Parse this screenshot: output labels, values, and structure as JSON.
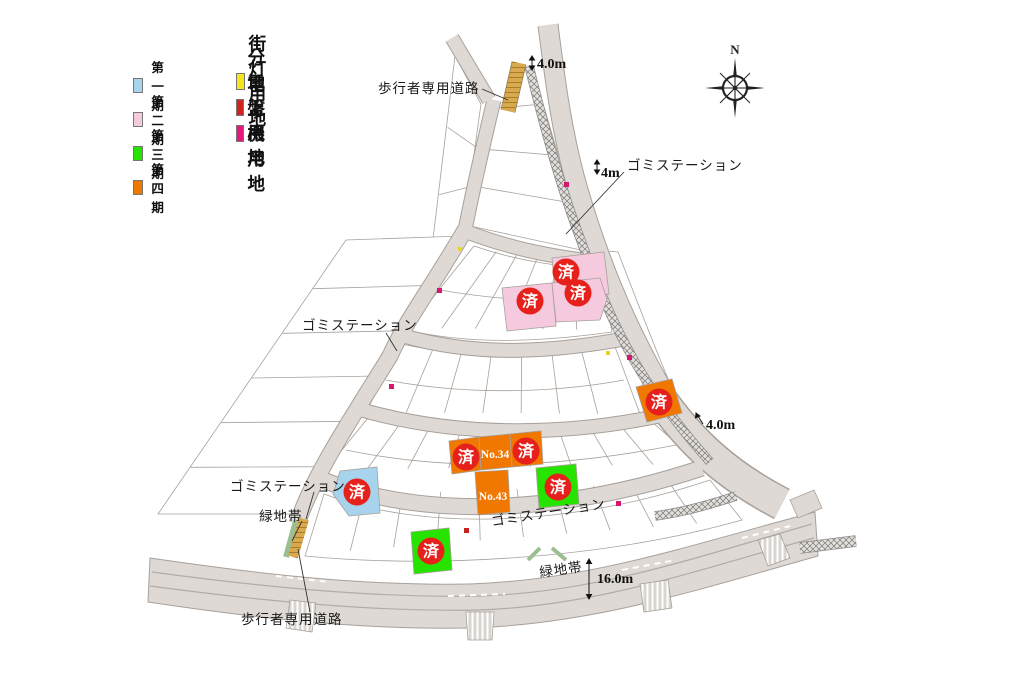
{
  "legend": {
    "phases": [
      {
        "label": "第一期",
        "color": "#a7d4ec"
      },
      {
        "label": "第二期",
        "color": "#f5cade"
      },
      {
        "label": "第三期",
        "color": "#27e300"
      },
      {
        "label": "第四期",
        "color": "#f07800"
      }
    ],
    "facilities": [
      {
        "label": "街灯用地",
        "color": "#f5e51e"
      },
      {
        "label": "分電盤用地",
        "color": "#cf2420"
      },
      {
        "label": "地上機用地",
        "color": "#e6187e"
      }
    ]
  },
  "compass": {
    "north_label": "N"
  },
  "sold_marker": "済",
  "lot_numbers": {
    "no34": "No.34",
    "no43": "No.43"
  },
  "annotations": {
    "pedestrian_road_top": "歩行者専用道路",
    "pedestrian_road_bottom": "歩行者専用道路",
    "garbage_station_top": "ゴミステーション",
    "garbage_station_mid": "ゴミステーション",
    "garbage_station_left": "ゴミステーション",
    "garbage_station_road": "ゴミステーション",
    "green_belt_left": "緑地帯",
    "green_belt_bottom": "緑地帯",
    "width_top": "4.0m",
    "width_4m": "4m",
    "width_right": "4.0m",
    "width_bottom": "16.0m"
  },
  "map_colors": {
    "road": "#ded9d4",
    "road_edge": "#a8a09a",
    "lot_line": "#a8a09a",
    "sold_badge": "#e6211c",
    "pedestrian_strip": "#d8a94f",
    "green_belt": "#9cbf92"
  }
}
